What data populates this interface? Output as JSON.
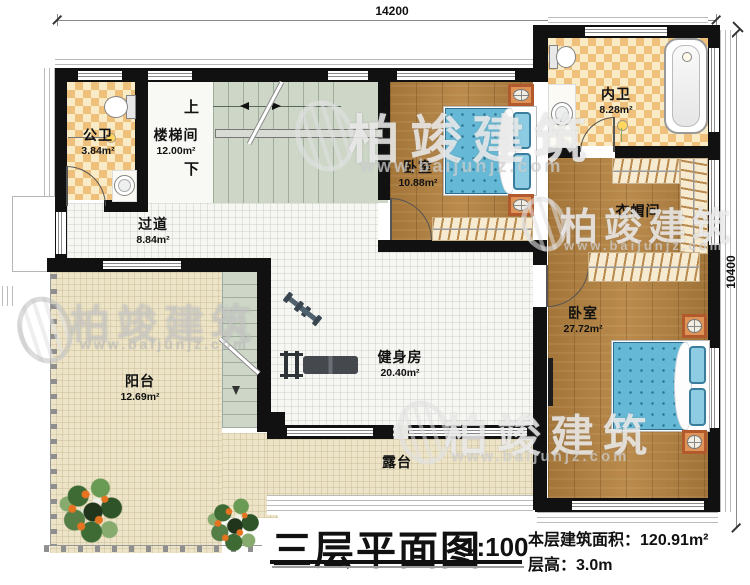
{
  "dimensions": {
    "top": "14200",
    "right": "10400"
  },
  "rooms": [
    {
      "name": "公卫",
      "area": "3.84m²"
    },
    {
      "name": "楼梯间",
      "area": "12.00m²"
    },
    {
      "name": "过道",
      "area": "8.84m²"
    },
    {
      "name": "卧室",
      "area": "10.88m²"
    },
    {
      "name": "内卫",
      "area": "8.28m²"
    },
    {
      "name": "衣帽间",
      "area": ""
    },
    {
      "name": "卧室",
      "area": "27.72m²"
    },
    {
      "name": "阳台",
      "area": "12.69m²"
    },
    {
      "name": "健身房",
      "area": "20.40m²"
    },
    {
      "name": "露台",
      "area": ""
    }
  ],
  "stairs": {
    "up": "上",
    "down": "下"
  },
  "watermark": {
    "brand": "柏竣建筑",
    "url": "www.baijunjz.com"
  },
  "titleblock": {
    "title": "三层平面图",
    "scale": "1:100",
    "area_label": "本层建筑面积：",
    "area_value": "120.91m²",
    "height_label": "层高：",
    "height_value": "3.0m"
  },
  "colors": {
    "wall": "#111111",
    "wood_floor": "#b5823f",
    "tile_checker_dark": "#eec07c",
    "tile_checker_light": "#f9ebc6",
    "stair_floor": "#cdd6c7",
    "hall_floor": "#f6f7f3",
    "terrace_floor": "#ede4c7",
    "bed_blue": "#66b9d6",
    "nightstand_orange": "#e09357"
  }
}
